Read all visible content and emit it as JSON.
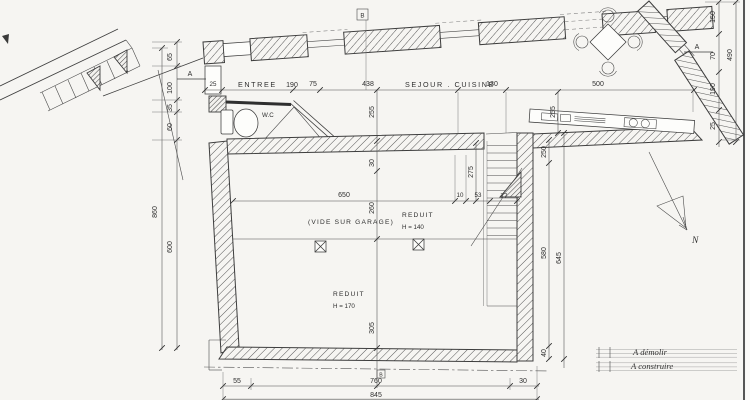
{
  "drawing": {
    "type": "architectural floor plan (scanned)",
    "colors": {
      "paper": "#f6f5f2",
      "ink": "#3d3d3d"
    }
  },
  "rooms": {
    "entree": "ENTREE",
    "sejour_cuisine": "SEJOUR . CUISINE",
    "wc": "W.C",
    "vide_sur_garage": "(VIDE SUR GARAGE)",
    "reduit_upper": {
      "label": "REDUIT",
      "height": "H = 140"
    },
    "reduit_lower": {
      "label": "REDUIT",
      "height": "H = 170"
    }
  },
  "dims": {
    "top": {
      "d25": "25",
      "d190": "190",
      "d75": "75",
      "d438": "438",
      "d130": "130",
      "d500": "500"
    },
    "left": {
      "d65": "65",
      "d100": "100",
      "d35": "35",
      "d60": "60",
      "d600": "600",
      "d860": "860"
    },
    "right": {
      "d150": "150",
      "d70": "70",
      "d190": "190",
      "d25": "25",
      "d490": "490"
    },
    "section_b": {
      "d255": "255",
      "d30": "30",
      "d260": "260",
      "d305": "305"
    },
    "sejour": {
      "d255": "255"
    },
    "garage": {
      "d650": "650",
      "d10": "10",
      "d53": "53",
      "d77": "77",
      "d275": "275"
    },
    "right_lower": {
      "d250": "250",
      "d580": "580",
      "d645": "645",
      "d40": "40"
    },
    "bottom": {
      "d55": "55",
      "d760": "760",
      "d30": "30",
      "d845": "845"
    }
  },
  "markers": {
    "section_a": "A",
    "section_b": "B",
    "north": "N"
  },
  "legend": {
    "demolish": "A démolir",
    "build": "A construire"
  }
}
